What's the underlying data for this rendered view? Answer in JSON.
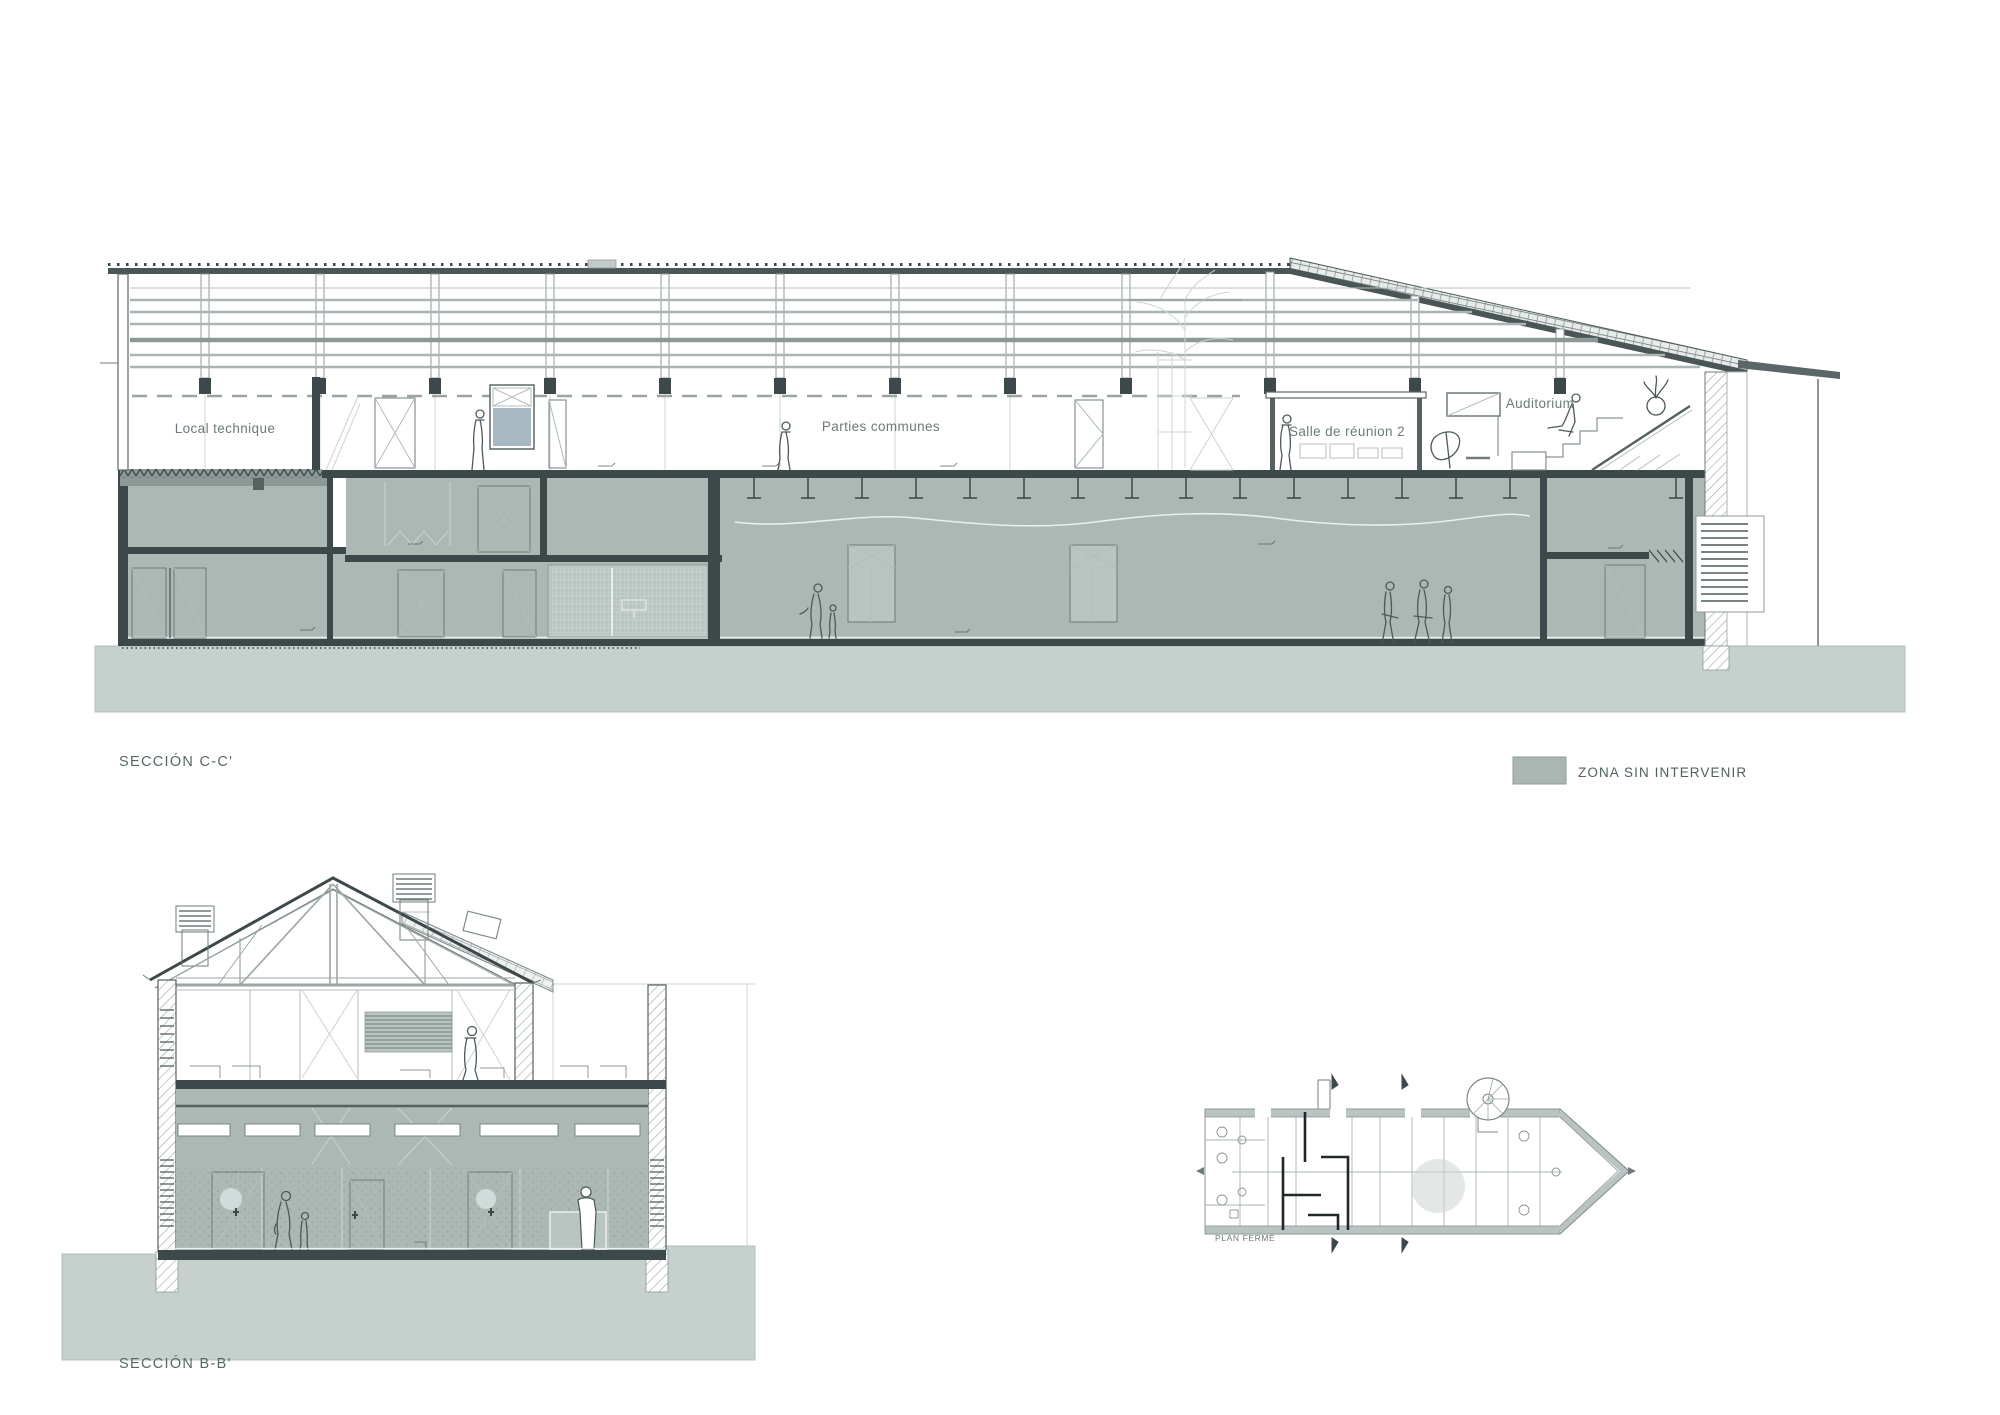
{
  "colors": {
    "zone_fill": "#abb8b4",
    "zone_fill_light": "#bac6c2",
    "ground_fill": "#c6d1cd",
    "slab_dark": "#3c4849",
    "roof_dark": "#4a5556",
    "line": "#6e7c7b",
    "line_light": "#b4bebc",
    "text": "#5f6f6e",
    "glass_teal": "#8aa2ab"
  },
  "section_cc": {
    "label": "SECCIÓN C-C'",
    "rooms": [
      {
        "label": "Local technique"
      },
      {
        "label": "Parties communes"
      },
      {
        "label": "Salle de réunion 2"
      },
      {
        "label": "Auditorium"
      }
    ]
  },
  "legend": {
    "label": "ZONA SIN INTERVENIR",
    "swatch_color": "#a9b6b2"
  },
  "section_bb": {
    "label": "SECCIÓN B-B'"
  },
  "floor_plan": {
    "label": "PLAN FERMÉ"
  }
}
